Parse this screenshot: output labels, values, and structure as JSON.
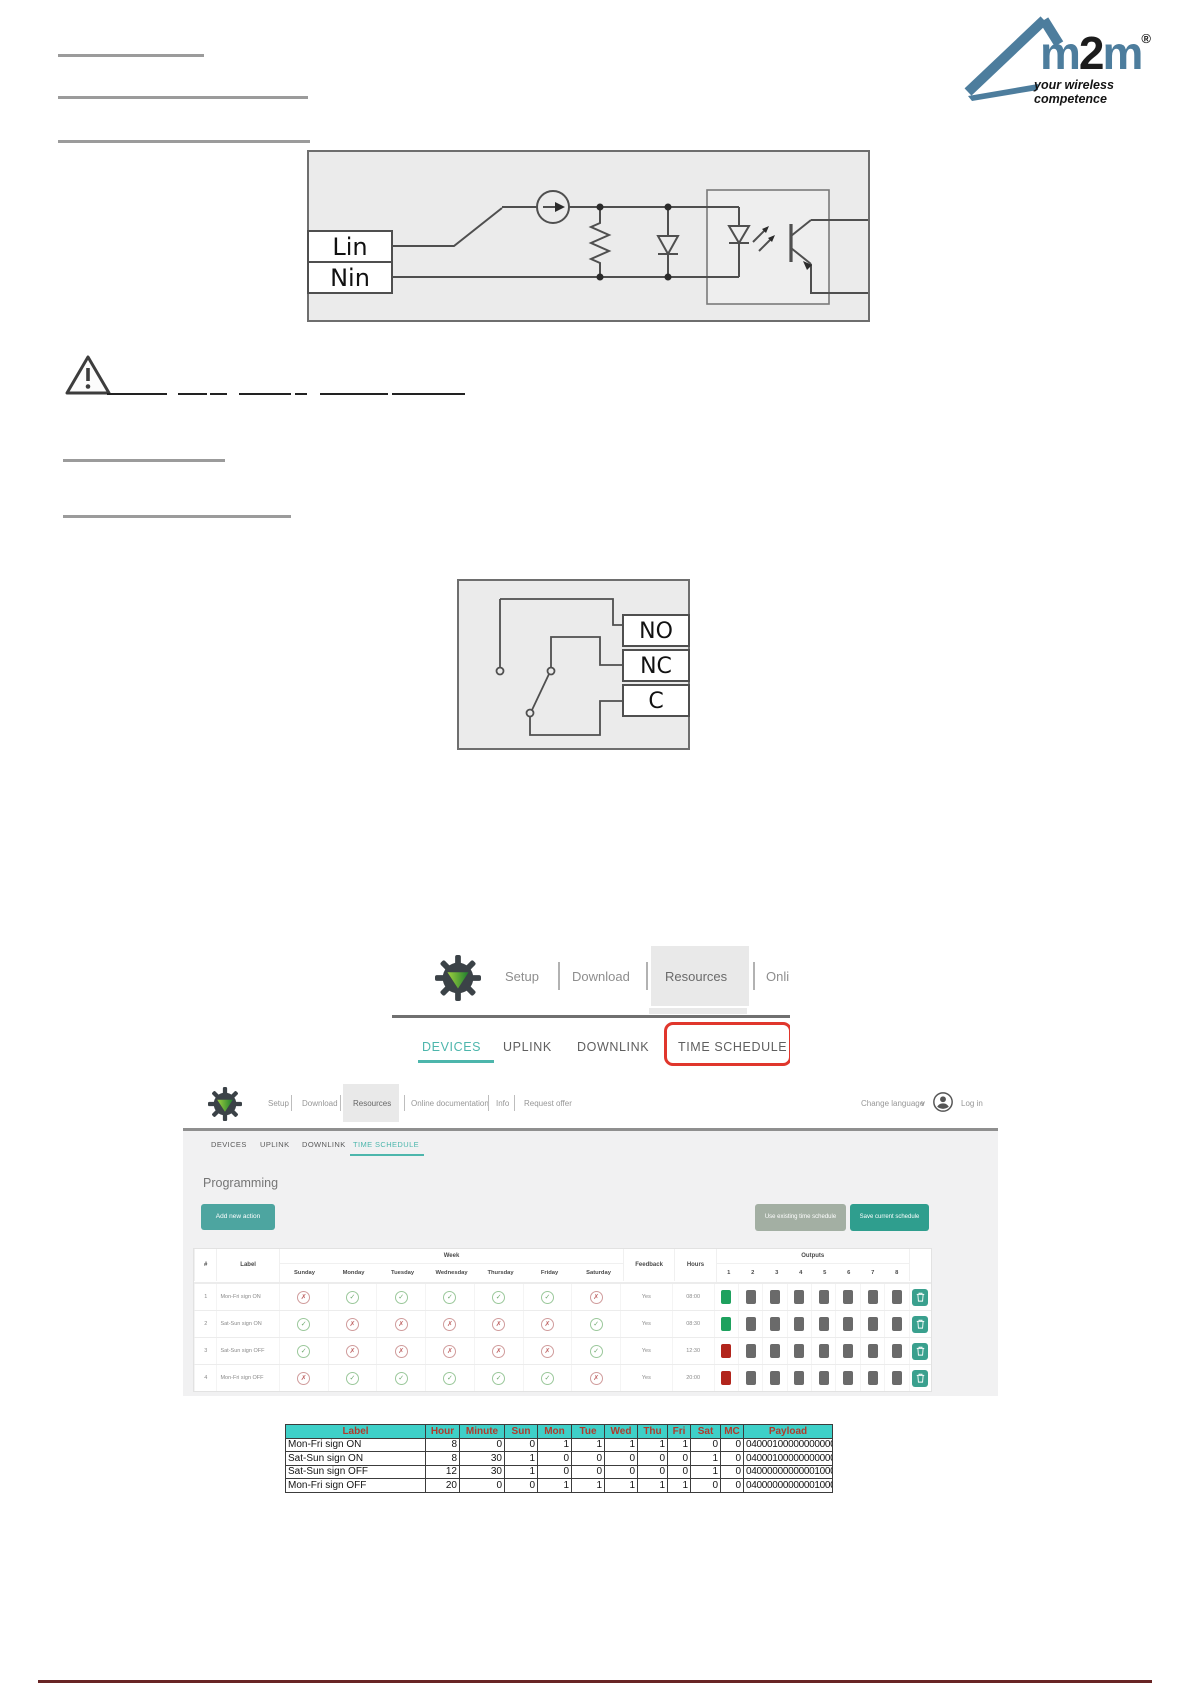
{
  "logo": {
    "brand_m1": "m",
    "brand_2": "2",
    "brand_m2": "m",
    "registered": "®",
    "tagline": "your wireless competence"
  },
  "icons": {
    "chevron_down": "∨"
  },
  "input_diagram": {
    "lin_label": "Lin",
    "nin_label": "Nin"
  },
  "relay_diagram": {
    "no_label": "NO",
    "nc_label": "NC",
    "c_label": "C"
  },
  "menu_crop": {
    "setup": "Setup",
    "download": "Download",
    "resources": "Resources",
    "online_partial": "Online d"
  },
  "tabs_crop": {
    "devices": "DEVICES",
    "uplink": "UPLINK",
    "downlink": "DOWNLINK",
    "time_schedule": "TIME SCHEDULE"
  },
  "app": {
    "menu": {
      "setup": "Setup",
      "download": "Download",
      "resources": "Resources",
      "online_documentation": "Online documentation",
      "info": "Info",
      "request_offer": "Request offer"
    },
    "change_language": "Change language",
    "log_in": "Log in",
    "tabs": {
      "devices": "DEVICES",
      "uplink": "UPLINK",
      "downlink": "DOWNLINK",
      "time_schedule": "TIME SCHEDULE"
    },
    "title": "Programming",
    "buttons": {
      "add": "Add new action",
      "use": "Use existing time schedule",
      "save": "Save current schedule"
    },
    "table": {
      "headers": {
        "num": "#",
        "label": "Label",
        "week": "Week",
        "feedback": "Feedback",
        "hours": "Hours",
        "outputs": "Outputs"
      },
      "days": [
        "Sunday",
        "Monday",
        "Tuesday",
        "Wednesday",
        "Thursday",
        "Friday",
        "Saturday"
      ],
      "output_numbers": [
        "1",
        "2",
        "3",
        "4",
        "5",
        "6",
        "7",
        "8"
      ],
      "rows": [
        {
          "num": "1",
          "label": "Mon-Fri sign ON",
          "days": [
            {
              "g": "✗",
              "c": "no"
            },
            {
              "g": "✓",
              "c": "yes"
            },
            {
              "g": "✓",
              "c": "yes"
            },
            {
              "g": "✓",
              "c": "yes"
            },
            {
              "g": "✓",
              "c": "yes"
            },
            {
              "g": "✓",
              "c": "yes"
            },
            {
              "g": "✗",
              "c": "no"
            }
          ],
          "feedback": "Yes",
          "hours": "08:00",
          "out1": "on"
        },
        {
          "num": "2",
          "label": "Sat-Sun sign ON",
          "days": [
            {
              "g": "✓",
              "c": "yes"
            },
            {
              "g": "✗",
              "c": "no"
            },
            {
              "g": "✗",
              "c": "no"
            },
            {
              "g": "✗",
              "c": "no"
            },
            {
              "g": "✗",
              "c": "no"
            },
            {
              "g": "✗",
              "c": "no"
            },
            {
              "g": "✓",
              "c": "yes"
            }
          ],
          "feedback": "Yes",
          "hours": "08:30",
          "out1": "on"
        },
        {
          "num": "3",
          "label": "Sat-Sun sign OFF",
          "days": [
            {
              "g": "✓",
              "c": "yes"
            },
            {
              "g": "✗",
              "c": "no"
            },
            {
              "g": "✗",
              "c": "no"
            },
            {
              "g": "✗",
              "c": "no"
            },
            {
              "g": "✗",
              "c": "no"
            },
            {
              "g": "✗",
              "c": "no"
            },
            {
              "g": "✓",
              "c": "yes"
            }
          ],
          "feedback": "Yes",
          "hours": "12:30",
          "out1": "off"
        },
        {
          "num": "4",
          "label": "Mon-Fri sign OFF",
          "days": [
            {
              "g": "✗",
              "c": "no"
            },
            {
              "g": "✓",
              "c": "yes"
            },
            {
              "g": "✓",
              "c": "yes"
            },
            {
              "g": "✓",
              "c": "yes"
            },
            {
              "g": "✓",
              "c": "yes"
            },
            {
              "g": "✓",
              "c": "yes"
            },
            {
              "g": "✗",
              "c": "no"
            }
          ],
          "feedback": "Yes",
          "hours": "20:00",
          "out1": "off"
        }
      ]
    }
  },
  "schedule_table": {
    "headers": [
      "Label",
      "Hour",
      "Minute",
      "Sun",
      "Mon",
      "Tue",
      "Wed",
      "Thu",
      "Fri",
      "Sat",
      "MC",
      "Payload"
    ],
    "rows": [
      [
        "Mon-Fri sign ON",
        "8",
        "0",
        "0",
        "1",
        "1",
        "1",
        "1",
        "1",
        "0",
        "0",
        "04000100000000000000"
      ],
      [
        "Sat-Sun sign ON",
        "8",
        "30",
        "1",
        "0",
        "0",
        "0",
        "0",
        "0",
        "1",
        "0",
        "04000100000000000000"
      ],
      [
        "Sat-Sun sign OFF",
        "12",
        "30",
        "1",
        "0",
        "0",
        "0",
        "0",
        "0",
        "1",
        "0",
        "04000000000001000000"
      ],
      [
        "Mon-Fri sign OFF",
        "20",
        "0",
        "0",
        "1",
        "1",
        "1",
        "1",
        "1",
        "0",
        "0",
        "04000000000001000000"
      ]
    ]
  }
}
